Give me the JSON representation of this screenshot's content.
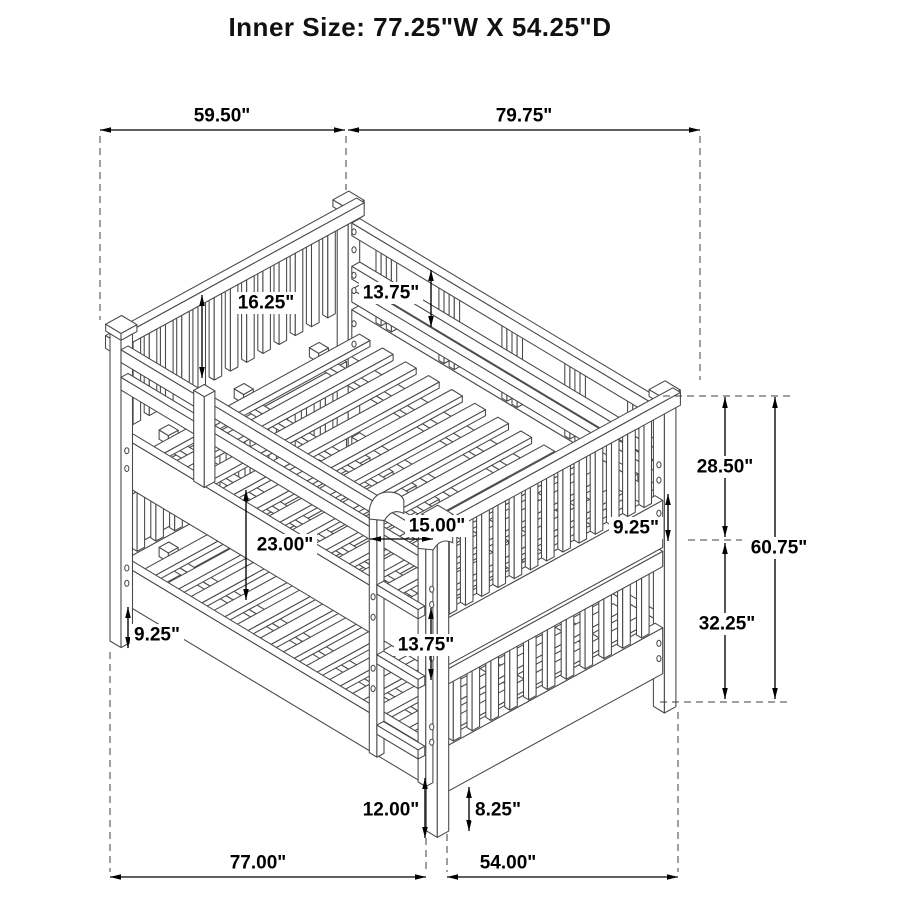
{
  "title": "Inner Size: 77.25\"W X 54.25\"D",
  "dimensions": {
    "depth_overall": {
      "label": "59.50\""
    },
    "width_overall": {
      "label": "79.75\""
    },
    "headboard_panel_height": {
      "label": "16.25\""
    },
    "guard_rail_drop": {
      "label": "13.75\""
    },
    "upper_section_height": {
      "label": "28.50\""
    },
    "overall_height": {
      "label": "60.75\""
    },
    "lower_section_height": {
      "label": "32.25\""
    },
    "guard_rail_height": {
      "label": "9.25\""
    },
    "ladder_width": {
      "label": "15.00\""
    },
    "bunk_gap_height": {
      "label": "23.00\""
    },
    "lower_rail_clearance": {
      "label": "9.25\""
    },
    "ladder_rung_spacing": {
      "label": "13.75\""
    },
    "ladder_ground_clearance": {
      "label": "12.00\""
    },
    "leg_clearance": {
      "label": "8.25\""
    },
    "floor_width": {
      "label": "77.00\""
    },
    "floor_depth": {
      "label": "54.00\""
    }
  }
}
